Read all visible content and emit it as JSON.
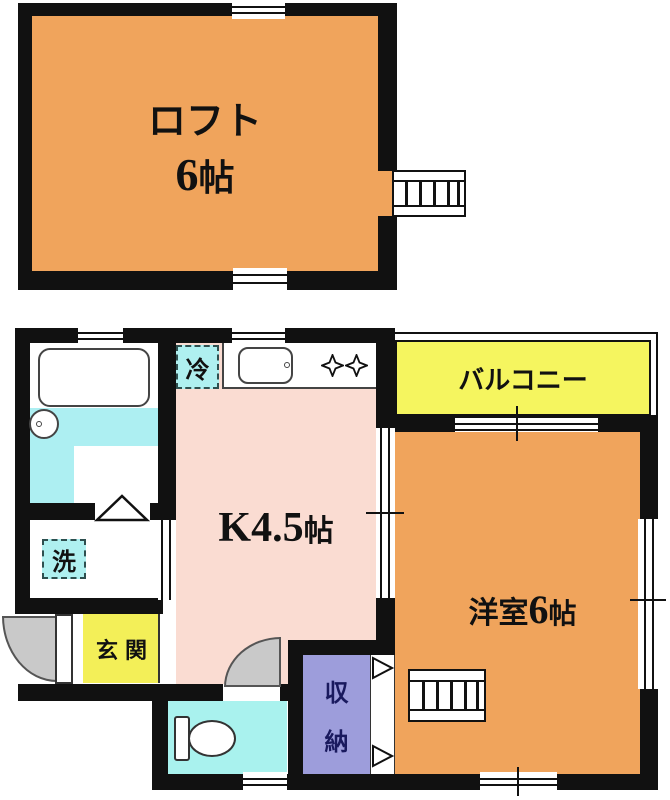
{
  "title": "1K apartment floor plan with loft",
  "colors": {
    "wall": "#111111",
    "loft_and_western_room": "#F0A45C",
    "kitchen": "#FADCD2",
    "balcony": "#F5F55F",
    "entrance": "#F3EF58",
    "bathroom_floor": "#ADEFF2",
    "toilet_room": "#A9F2EE",
    "storage": "#9D9DDB",
    "door_leaf": "#C9C9C9",
    "label_box": "#AFF0F0",
    "storage_text": "#1a1a5e"
  },
  "loft": {
    "name": "ロフト",
    "size_num": "6",
    "size_unit": "帖"
  },
  "rooms": {
    "kitchen": {
      "prefix": "K",
      "num": "4.5",
      "unit": "帖"
    },
    "western": {
      "name": "洋室",
      "num": "6",
      "unit": "帖"
    },
    "balcony": {
      "label": "バルコニー"
    },
    "entrance": {
      "label": "玄関"
    },
    "storage": {
      "char1": "収",
      "char2": "納"
    },
    "fridge": {
      "label": "冷"
    },
    "washer": {
      "label": "洗"
    }
  }
}
